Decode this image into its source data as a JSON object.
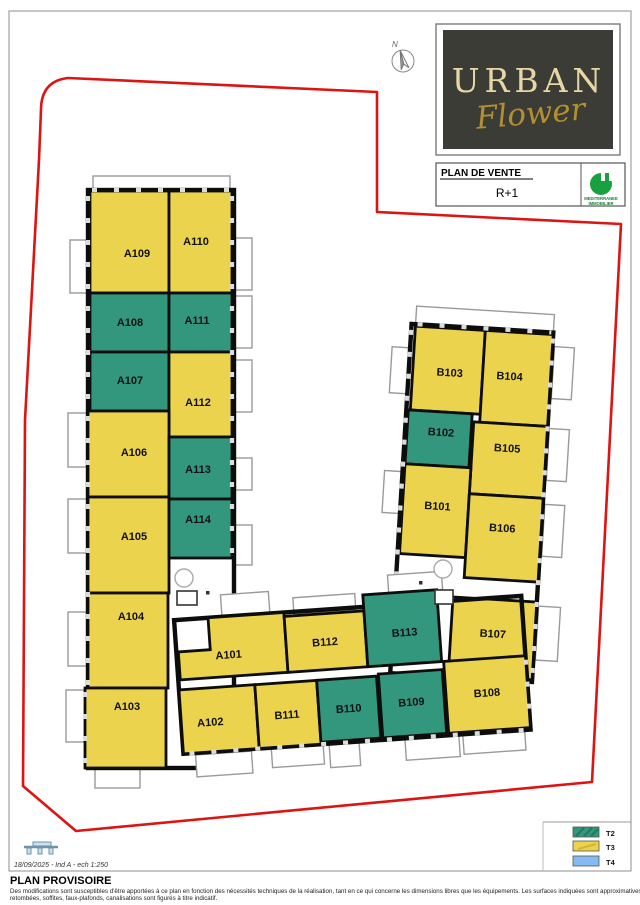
{
  "page": {
    "compass_label": "N",
    "title_block": {
      "logo_line1": "URBAN",
      "logo_line2": "Flower",
      "plan_label": "PLAN DE VENTE",
      "floor": "R+1",
      "agency_line1": "MEDITERRANEE",
      "agency_line2": "IMMOBILIER"
    },
    "legend": [
      {
        "code": "T2",
        "color": "#33977d"
      },
      {
        "code": "T3",
        "color": "#ecd34e"
      },
      {
        "code": "T4",
        "color": "#85bbf2"
      }
    ],
    "footer": {
      "scale_note": "18/09/2025 - Ind A - ech 1:250",
      "title": "PLAN PROVISOIRE",
      "disclaimer_line1": "Des modifications sont susceptibles d'être apportées à ce plan en fonction des nécessités techniques de la réalisation, tant en ce qui concerne les dimensions libres que les équipements. Les surfaces indiquées sont approximatives, les",
      "disclaimer_line2": "retombées, soffites, faux-plafonds, canalisations sont figurés à titre indicatif."
    }
  },
  "plan": {
    "colors": {
      "T2": "#33977d",
      "T3": "#ecd34e",
      "wall": "#0d0d0d",
      "boundary": "#dd1412"
    },
    "rooms": [
      {
        "id": "A109",
        "type": "T3",
        "wing": "left",
        "rect": [
          90,
          191,
          79,
          102
        ],
        "label": [
          137,
          257
        ]
      },
      {
        "id": "A110",
        "type": "T3",
        "wing": "left",
        "rect": [
          169,
          191,
          63,
          102
        ],
        "label": [
          196,
          245
        ]
      },
      {
        "id": "A108",
        "type": "T2",
        "wing": "left",
        "rect": [
          90,
          293,
          79,
          59
        ],
        "label": [
          130,
          326
        ]
      },
      {
        "id": "A111",
        "type": "T2",
        "wing": "left",
        "rect": [
          169,
          293,
          63,
          59
        ],
        "label": [
          197,
          324
        ]
      },
      {
        "id": "A107",
        "type": "T2",
        "wing": "left",
        "rect": [
          90,
          352,
          79,
          59
        ],
        "label": [
          130,
          384
        ]
      },
      {
        "id": "A112",
        "type": "T3",
        "wing": "left",
        "rect": [
          169,
          352,
          63,
          85
        ],
        "label": [
          198,
          406
        ]
      },
      {
        "id": "A106",
        "type": "T3",
        "wing": "left",
        "rect": [
          88,
          411,
          81,
          86
        ],
        "label": [
          134,
          456
        ]
      },
      {
        "id": "A113",
        "type": "T2",
        "wing": "left",
        "rect": [
          169,
          437,
          63,
          62
        ],
        "label": [
          198,
          473
        ]
      },
      {
        "id": "A105",
        "type": "T3",
        "wing": "left",
        "rect": [
          88,
          497,
          81,
          96
        ],
        "label": [
          134,
          540
        ]
      },
      {
        "id": "A114",
        "type": "T2",
        "wing": "left",
        "rect": [
          169,
          499,
          63,
          59
        ],
        "label": [
          198,
          523
        ]
      },
      {
        "id": "A104",
        "type": "T3",
        "wing": "left",
        "rect": [
          88,
          593,
          80,
          95
        ],
        "label": [
          131,
          620
        ]
      },
      {
        "id": "A103",
        "type": "T3",
        "wing": "left",
        "rect": [
          85,
          688,
          81,
          80
        ],
        "label": [
          127,
          710
        ]
      },
      {
        "id": "A101",
        "type": "T3",
        "wing": "bottom",
        "poly": [
          [
            180,
            640
          ],
          [
            212,
            640
          ],
          [
            212,
            608
          ],
          [
            288,
            608
          ],
          [
            288,
            668
          ],
          [
            180,
            668
          ]
        ],
        "label": [
          230,
          650
        ]
      },
      {
        "id": "B112",
        "type": "T3",
        "wing": "bottom",
        "rect": [
          288,
          612,
          80,
          56
        ],
        "label": [
          327,
          644
        ]
      },
      {
        "id": "B113",
        "type": "T2",
        "wing": "bottom",
        "rect": [
          368,
          596,
          74,
          72
        ],
        "label": [
          407,
          640
        ]
      },
      {
        "id": "A102",
        "type": "T3",
        "wing": "bottom",
        "rect": [
          178,
          678,
          76,
          64
        ],
        "label": [
          207,
          716
        ]
      },
      {
        "id": "B111",
        "type": "T3",
        "wing": "bottom",
        "rect": [
          254,
          678,
          62,
          64
        ],
        "label": [
          284,
          714
        ]
      },
      {
        "id": "B110",
        "type": "T2",
        "wing": "bottom",
        "rect": [
          316,
          678,
          60,
          62
        ],
        "label": [
          346,
          712
        ]
      },
      {
        "id": "B109",
        "type": "T2",
        "wing": "bottom",
        "rect": [
          378,
          676,
          64,
          64
        ],
        "label": [
          409,
          710
        ]
      },
      {
        "id": "B108",
        "type": "T3",
        "wing": "bottom",
        "rect": [
          444,
          668,
          82,
          72
        ],
        "label": [
          485,
          706
        ]
      },
      {
        "id": "B103",
        "type": "T3",
        "wing": "right",
        "rect": [
          408,
          330,
          70,
          84
        ],
        "label": [
          445,
          378
        ]
      },
      {
        "id": "B104",
        "type": "T3",
        "wing": "right",
        "rect": [
          478,
          330,
          68,
          92
        ],
        "label": [
          505,
          378
        ]
      },
      {
        "id": "B102",
        "type": "T2",
        "wing": "right",
        "rect": [
          406,
          414,
          64,
          54
        ],
        "label": [
          440,
          438
        ]
      },
      {
        "id": "B105",
        "type": "T3",
        "wing": "right",
        "rect": [
          472,
          422,
          74,
          72
        ],
        "label": [
          507,
          450
        ]
      },
      {
        "id": "B101",
        "type": "T3",
        "wing": "right",
        "rect": [
          406,
          468,
          66,
          90
        ],
        "label": [
          441,
          512
        ]
      },
      {
        "id": "B106",
        "type": "T3",
        "wing": "right",
        "rect": [
          472,
          494,
          74,
          84
        ],
        "label": [
          507,
          530
        ]
      },
      {
        "id": "B107",
        "type": "T3",
        "wing": "right",
        "rect": [
          462,
          598,
          84,
          78
        ],
        "label": [
          504,
          636
        ]
      }
    ],
    "balconies": [
      {
        "wing": "left",
        "rect": [
          93,
          176,
          137,
          15
        ]
      },
      {
        "wing": "left",
        "rect": [
          70,
          240,
          19,
          53
        ]
      },
      {
        "wing": "left",
        "rect": [
          68,
          413,
          20,
          54
        ]
      },
      {
        "wing": "left",
        "rect": [
          68,
          499,
          20,
          54
        ]
      },
      {
        "wing": "left",
        "rect": [
          68,
          612,
          20,
          54
        ]
      },
      {
        "wing": "left",
        "rect": [
          66,
          690,
          20,
          52
        ]
      },
      {
        "wing": "left",
        "rect": [
          95,
          768,
          45,
          20
        ]
      },
      {
        "wing": "left",
        "rect": [
          234,
          238,
          18,
          52
        ]
      },
      {
        "wing": "left",
        "rect": [
          234,
          296,
          18,
          52
        ]
      },
      {
        "wing": "left",
        "rect": [
          234,
          360,
          18,
          52
        ]
      },
      {
        "wing": "left",
        "rect": [
          234,
          458,
          18,
          32
        ]
      },
      {
        "wing": "left",
        "rect": [
          234,
          525,
          18,
          40
        ]
      },
      {
        "wing": "right",
        "rect": [
          408,
          310,
          138,
          17
        ]
      },
      {
        "wing": "right",
        "rect": [
          548,
          342,
          20,
          52
        ]
      },
      {
        "wing": "right",
        "rect": [
          548,
          424,
          20,
          52
        ]
      },
      {
        "wing": "right",
        "rect": [
          548,
          500,
          20,
          52
        ]
      },
      {
        "wing": "right",
        "rect": [
          548,
          602,
          22,
          54
        ]
      },
      {
        "wing": "right",
        "rect": [
          386,
          352,
          17,
          46
        ]
      },
      {
        "wing": "right",
        "rect": [
          386,
          476,
          17,
          42
        ]
      },
      {
        "wing": "bottom",
        "rect": [
          190,
          744,
          56,
          22
        ]
      },
      {
        "wing": "bottom",
        "rect": [
          266,
          742,
          52,
          20
        ]
      },
      {
        "wing": "bottom",
        "rect": [
          324,
          742,
          30,
          24
        ]
      },
      {
        "wing": "bottom",
        "rect": [
          400,
          740,
          54,
          24
        ]
      },
      {
        "wing": "bottom",
        "rect": [
          458,
          738,
          62,
          24
        ]
      },
      {
        "wing": "bottom",
        "rect": [
          226,
          586,
          48,
          24
        ]
      },
      {
        "wing": "bottom",
        "rect": [
          298,
          594,
          62,
          16
        ]
      },
      {
        "wing": "bottom",
        "rect": [
          394,
          578,
          54,
          18
        ]
      }
    ]
  }
}
